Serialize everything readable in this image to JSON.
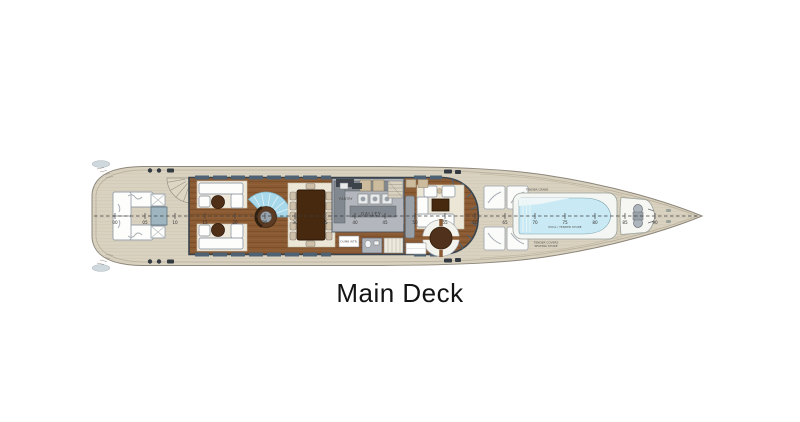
{
  "title": {
    "label": "Main Deck"
  },
  "ruler": {
    "tick_labels": [
      "00",
      "05",
      "10",
      "15",
      "20",
      "25",
      "30",
      "35",
      "40",
      "45",
      "50",
      "55",
      "60",
      "65",
      "70",
      "75",
      "80",
      "85",
      "90"
    ]
  },
  "labels": {
    "galley": "GALLEY",
    "pantry": "PANTRY",
    "dumbwaiter": "DUMB WTR.",
    "tender_crane": "TENDER CRANE",
    "pool_store": "POOL / TENDER STORE",
    "tender_covers": "TENDER COVERS",
    "seating_store": "SEATING STORE"
  },
  "colors": {
    "hull_deck": "#d9d2c0",
    "wood_floor": "#8a5a33",
    "galley_floor": "#b3b7bd",
    "pool_water": "#c9eaf4",
    "stair_fan": "#a8d9ea",
    "wall_outline": "#39434d",
    "dark_furniture": "#46290f"
  }
}
